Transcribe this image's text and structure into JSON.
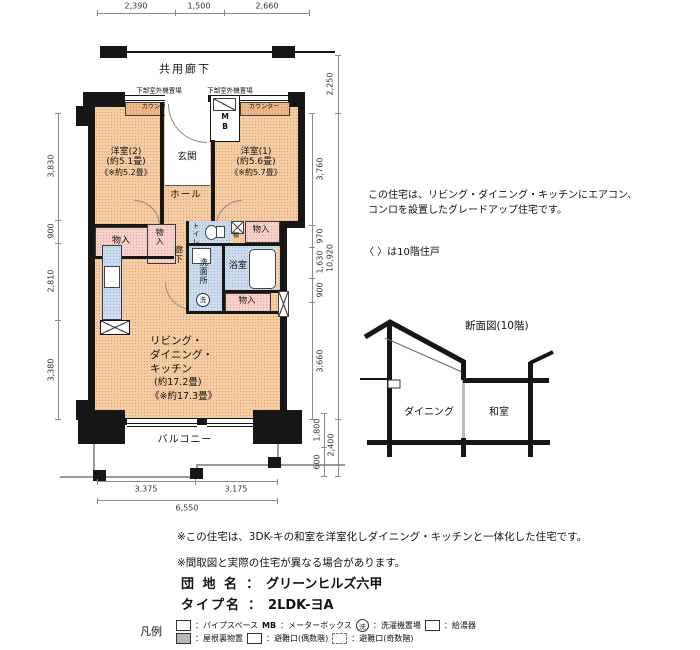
{
  "plan": {
    "corridor": "共用廊下",
    "outdoor_unit": "下部室外機置場",
    "counter": "カウンター",
    "mb": "MB",
    "genkan": "玄関",
    "hall": "ホール",
    "room2_name": "洋室(2)",
    "room2_area": "(約5.1畳)",
    "room2_area10": "《※約5.2畳》",
    "room1_name": "洋室(1)",
    "room1_area": "(約5.6畳)",
    "room1_area10": "《※約5.7畳》",
    "monoire": "物入",
    "tana": "棚",
    "toilet": "トイレ",
    "rouka": "廊下",
    "senmenjo": "洗面所",
    "sen": "洗",
    "bath": "浴室",
    "ldk_l1": "リビング・",
    "ldk_l2": "ダイニング・",
    "ldk_l3": "キッチン",
    "ldk_area": "(約17.2畳)",
    "ldk_area10": "《※約17.3畳》",
    "balcony": "バルコニー"
  },
  "dims": {
    "top": [
      "2,390",
      "1,500",
      "2,660"
    ],
    "left": [
      "3,830",
      "900",
      "2,810",
      "3,380"
    ],
    "right_corridor": "2,250",
    "right_inner": [
      "3,760",
      "970",
      "1,630",
      "900",
      "3,660"
    ],
    "right_total": "10,920",
    "balcony_depth": "1,800",
    "balcony_edge": "600",
    "balcony_total": "2,400",
    "bottom_left": "3,375",
    "bottom_right": "3,175",
    "bottom_total": "6,550"
  },
  "notes": {
    "right_line1": "この住宅は、リビング・ダイニング・キッチンにエアコン、",
    "right_line2": "コンロを設置したグレードアップ住宅です。",
    "floor_note": "〈 〉は10階住戸",
    "bottom_note1": "※この住宅は、3DK-キの和室を洋室化しダイニング・キッチンと一体化した住宅です。",
    "bottom_note2": "※間取図と実際の住宅が異なる場合があります。"
  },
  "section": {
    "title": "断面図(10階)",
    "dining": "ダイニング",
    "washitsu": "和室"
  },
  "footer": {
    "estate_label": "団 地 名",
    "colon": "：",
    "estate_name": "グリーンヒルズ六甲",
    "type_label": "タイプ名",
    "type_name": "2LDK-ヨA"
  },
  "legend": {
    "label": "凡例",
    "pipe_space": "：パイプスペース",
    "mb_sym": "MB",
    "mb_text": "：メーターボックス",
    "sen_sym": "洗",
    "washer": "：洗濯機置場",
    "heater": "：給湯器",
    "attic": "：屋根裏物置",
    "hatch_even": "：避難口(偶数階)",
    "hatch_odd": "：避難口(奇数階)"
  }
}
